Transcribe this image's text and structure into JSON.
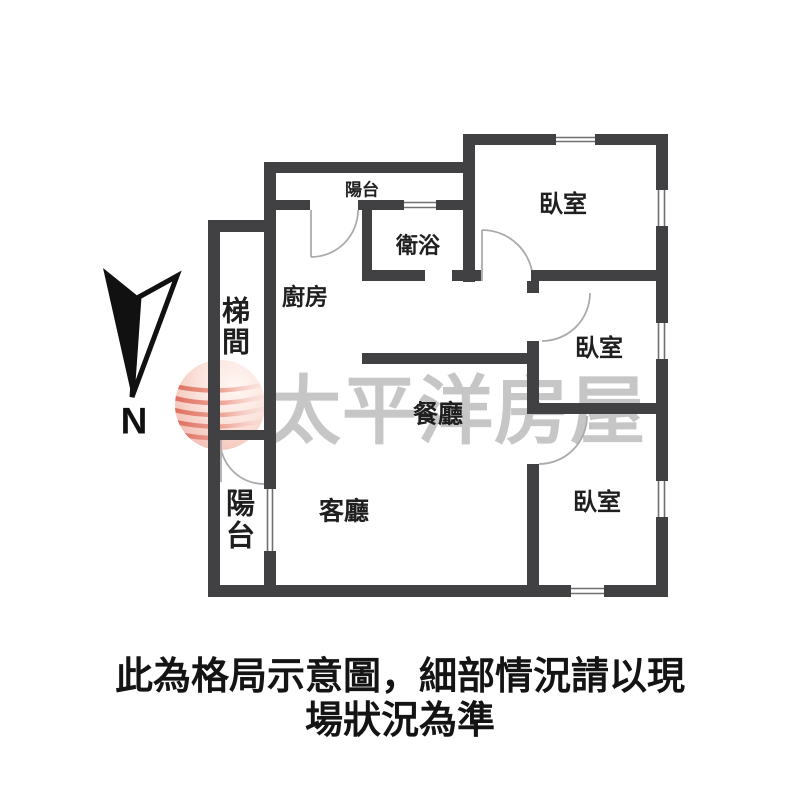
{
  "floor_plan": {
    "rooms": {
      "balcony_top": {
        "label": "陽台"
      },
      "bedroom_top": {
        "label": "臥室"
      },
      "bathroom": {
        "label": "衛浴"
      },
      "kitchen": {
        "label": "廚房"
      },
      "stairwell": {
        "label": "梯間"
      },
      "bedroom_middle": {
        "label": "臥室"
      },
      "dining_room": {
        "label": "餐廳"
      },
      "balcony_left": {
        "label": "陽台"
      },
      "living_room": {
        "label": "客廳"
      },
      "bedroom_bottom": {
        "label": "臥室"
      }
    },
    "compass": {
      "label": "N"
    },
    "colors": {
      "wall": "#414143",
      "door_arc": "#ababab",
      "window_line": "#707070",
      "room_label": "#1f1f1f"
    }
  },
  "watermark": {
    "text": "太平洋房屋",
    "text_color": "#c6c6c6",
    "logo_main_color": "#e8887a"
  },
  "caption": {
    "line1": "此為格局示意圖，細部情況請以現",
    "line2": "場狀況為準"
  }
}
